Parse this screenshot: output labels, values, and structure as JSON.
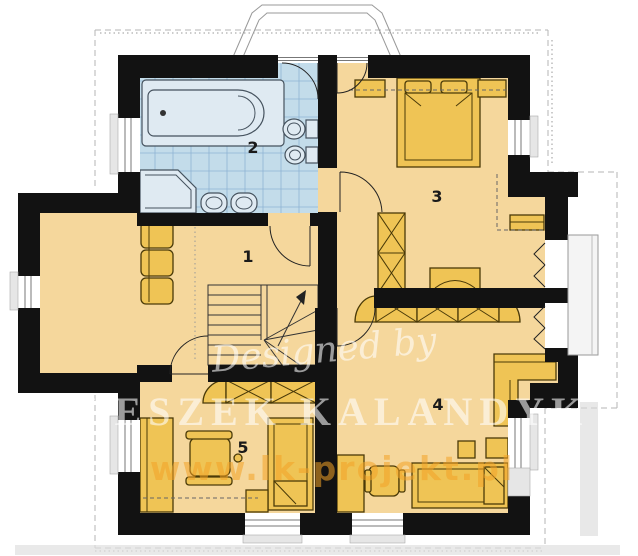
{
  "rooms": [
    {
      "label": "1"
    },
    {
      "label": "2"
    },
    {
      "label": "3"
    },
    {
      "label": "4"
    },
    {
      "label": "5"
    }
  ],
  "watermark": {
    "designed_by": "Designed by",
    "name": "LESZEK KALANDYK",
    "website": "www.lk-projekt.pl"
  },
  "colors": {
    "wall": "#121212",
    "floor": "#f5d79c",
    "furniture": "#efc455",
    "furniture_stroke": "#4a3a08",
    "bath_floor": "#c3dcea",
    "bath_grid": "#8fb4d4",
    "fixture": "#dfeaf2",
    "fixture_stroke": "#45525e",
    "outline": "#b5b5b5",
    "sill": "#e6e6e6",
    "balcony": "#f4f4f4",
    "arc": "#222222",
    "watermark_white": "rgba(255,255,255,0.58)",
    "watermark_orange": "rgba(243,163,38,0.55)"
  }
}
